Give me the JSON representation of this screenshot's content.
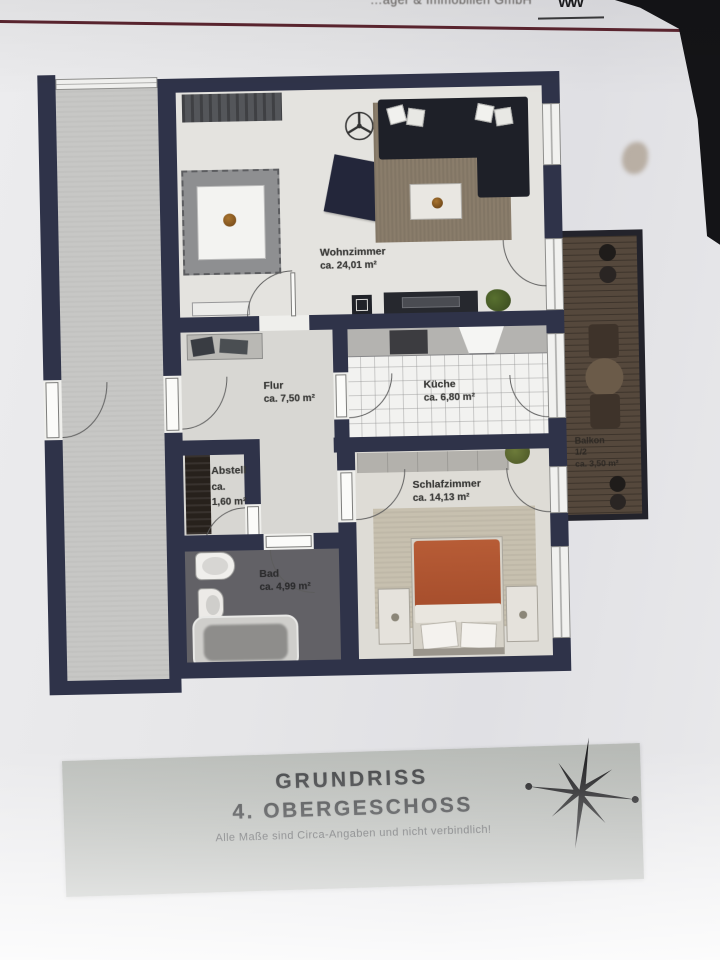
{
  "header": {
    "company": "…ager & Immobilien GmbH",
    "logo_glyph": "ẄẄ"
  },
  "rooms": {
    "wohnzimmer": {
      "label": "Wohnzimmer",
      "area": "ca. 24,01 m²"
    },
    "flur": {
      "label": "Flur",
      "area": "ca. 7,50 m²"
    },
    "kueche": {
      "label": "Küche",
      "area": "ca. 6,80 m²"
    },
    "abstell": {
      "label": "Abstell",
      "area_prefix": "ca.",
      "area": "1,60 m²"
    },
    "bad": {
      "label": "Bad",
      "area": "ca. 4,99 m²"
    },
    "schlafzimmer": {
      "label": "Schlafzimmer",
      "area": "ca. 14,13 m²"
    },
    "balkon": {
      "label": "Balkon",
      "note": "1/2",
      "area": "ca. 3,50 m²"
    }
  },
  "title_block": {
    "title": "GRUNDRISS",
    "subtitle": "4. OBERGESCHOSS",
    "disclaimer": "Alle Maße sind Circa-Angaben und nicht verbindlich!"
  },
  "colors": {
    "wall": "#2f3349",
    "paper": "#e6e6e8",
    "header_rule": "#5c2530",
    "title_block_bg": "#b5b8b4",
    "balcony_deck": "#55483c",
    "bed_duvet": "#ad5330",
    "living_rug": "#8a7d6b",
    "bath_floor": "#626166"
  }
}
